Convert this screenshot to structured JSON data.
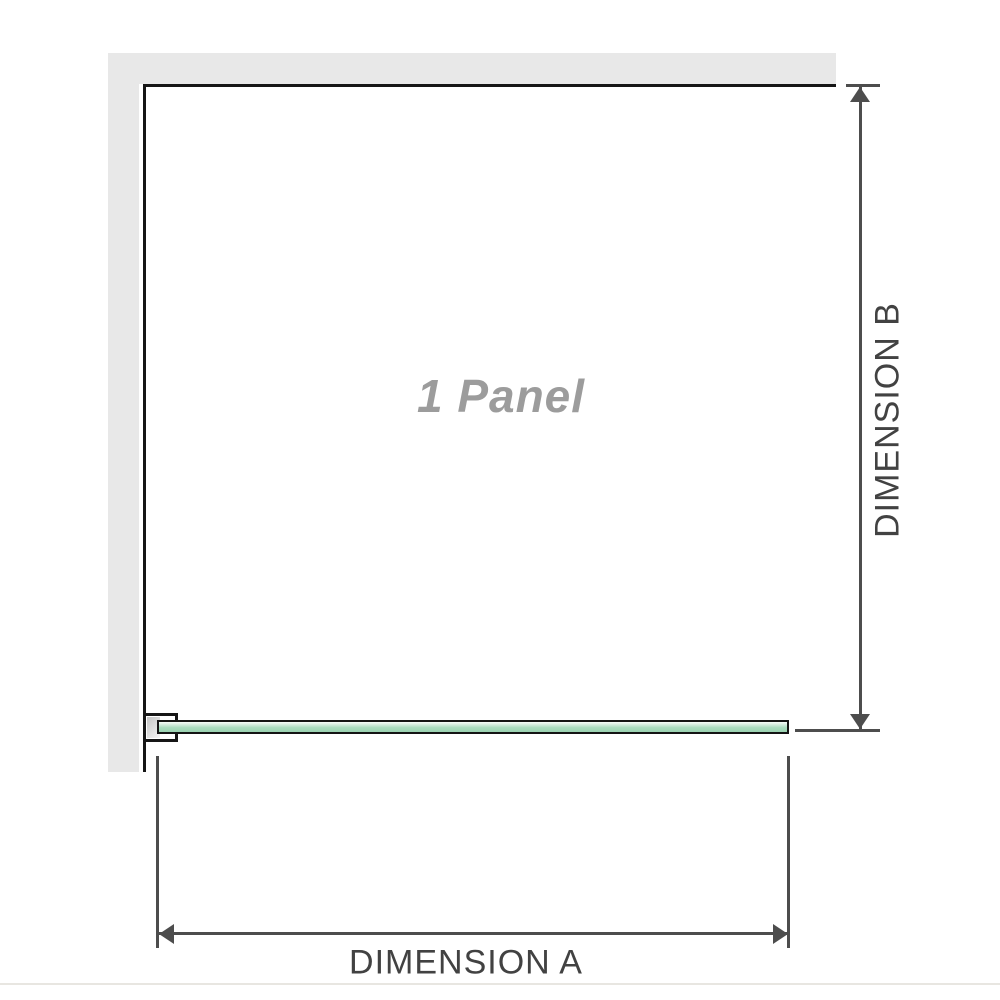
{
  "diagram": {
    "panel_label": "1 Panel",
    "dimension_a": {
      "label": "DIMENSION A"
    },
    "dimension_b": {
      "label": "DIMENSION B"
    }
  },
  "colors": {
    "wall_fill": "#e8e8e8",
    "wall_edge": "#161616",
    "glass_border": "#141414",
    "glass_light": "#f8fcf9",
    "glass_mid": "#abdcc0",
    "glass_dark": "#9ad2b0",
    "bracket_pad_dark": "#c4c4c4",
    "bracket_pad_light": "#f5f5f5",
    "dim_line": "#4d4d4d",
    "dim_text": "#424242",
    "panel_text": "#9c9c9c",
    "divider": "#e8e6e1"
  }
}
